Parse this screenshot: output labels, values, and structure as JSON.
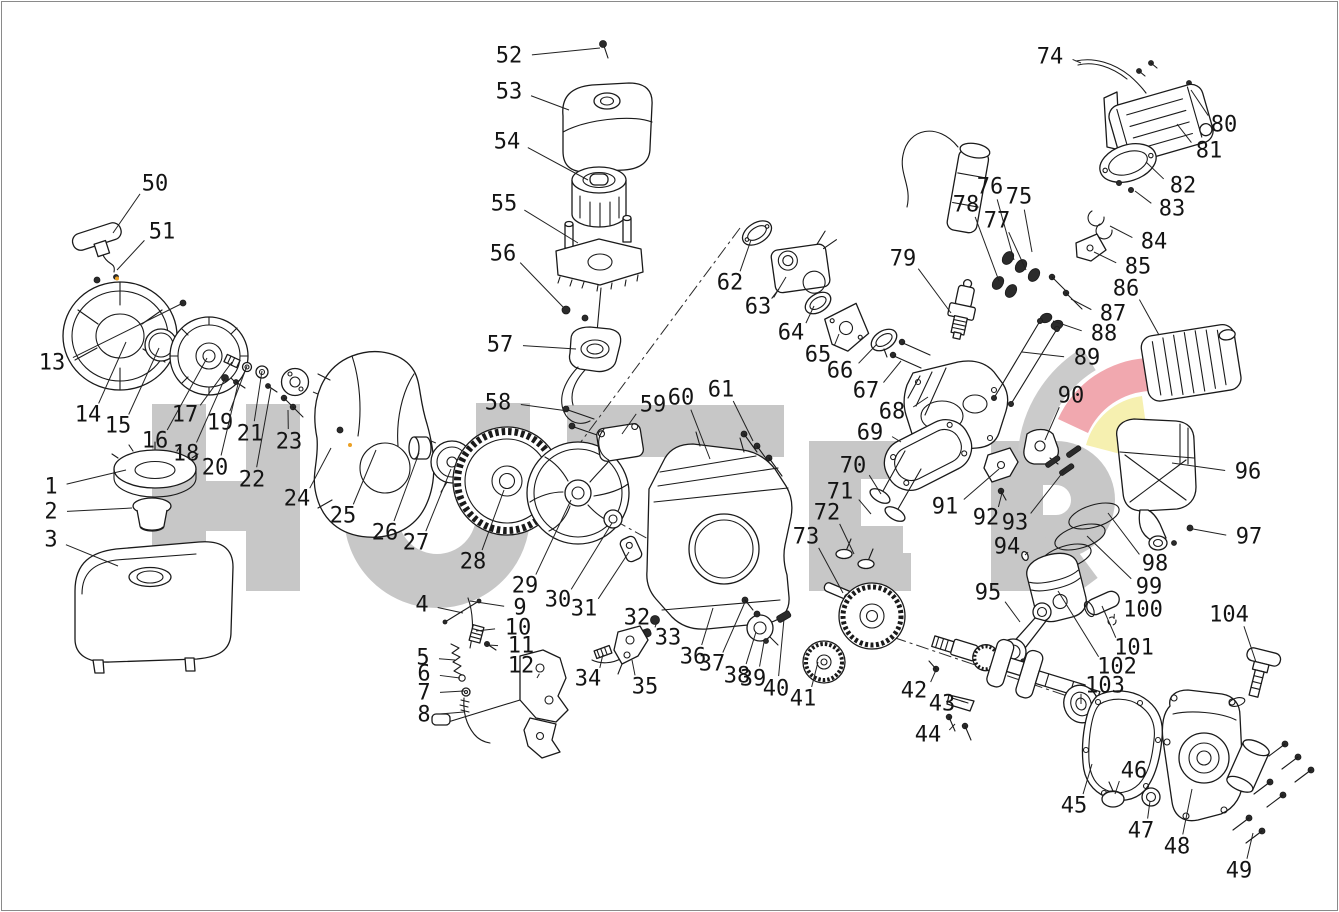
{
  "watermark": {
    "text": "HUTER",
    "letters_color": "#c7c7c7",
    "swoosh_gray": "#cbcbcb",
    "swoosh_red": "#f1a8af",
    "swoosh_yellow": "#f6f0b0"
  },
  "diagram": {
    "type": "exploded-parts-diagram",
    "part_count": 104,
    "accent_dot_color": "#eba024",
    "parts": [
      {
        "n": "1",
        "l": [
          51,
          487
        ],
        "t": [
          126,
          470
        ]
      },
      {
        "n": "2",
        "l": [
          51,
          512
        ],
        "t": [
          132,
          508
        ]
      },
      {
        "n": "3",
        "l": [
          51,
          540
        ],
        "t": [
          118,
          566
        ]
      },
      {
        "n": "4",
        "l": [
          422,
          605
        ],
        "t": [
          463,
          613
        ]
      },
      {
        "n": "5",
        "l": [
          423,
          658
        ],
        "t": [
          455,
          660
        ]
      },
      {
        "n": "6",
        "l": [
          424,
          674
        ],
        "t": [
          460,
          678
        ]
      },
      {
        "n": "7",
        "l": [
          424,
          693
        ],
        "t": [
          464,
          691
        ]
      },
      {
        "n": "8",
        "l": [
          424,
          715
        ],
        "t": [
          464,
          712
        ]
      },
      {
        "n": "9",
        "l": [
          520,
          608
        ],
        "t": [
          470,
          601
        ]
      },
      {
        "n": "10",
        "l": [
          518,
          628
        ],
        "t": [
          476,
          631
        ]
      },
      {
        "n": "11",
        "l": [
          521,
          646
        ],
        "t": [
          488,
          645
        ]
      },
      {
        "n": "12",
        "l": [
          521,
          666
        ],
        "t": [
          537,
          678
        ]
      },
      {
        "n": "13",
        "l": [
          52,
          363
        ],
        "t": [
          183,
          303
        ]
      },
      {
        "n": "14",
        "l": [
          88,
          415
        ],
        "t": [
          126,
          342
        ]
      },
      {
        "n": "15",
        "l": [
          118,
          426
        ],
        "t": [
          159,
          348
        ]
      },
      {
        "n": "16",
        "l": [
          155,
          441
        ],
        "t": [
          207,
          358
        ]
      },
      {
        "n": "17",
        "l": [
          185,
          415
        ],
        "t": [
          232,
          362
        ]
      },
      {
        "n": "18",
        "l": [
          186,
          454
        ],
        "t": [
          225,
          378
        ]
      },
      {
        "n": "19",
        "l": [
          220,
          423
        ],
        "t": [
          247,
          366
        ]
      },
      {
        "n": "20",
        "l": [
          215,
          468
        ],
        "t": [
          238,
          384
        ]
      },
      {
        "n": "21",
        "l": [
          250,
          434
        ],
        "t": [
          262,
          371
        ]
      },
      {
        "n": "22",
        "l": [
          252,
          480
        ],
        "t": [
          271,
          388
        ]
      },
      {
        "n": "23",
        "l": [
          289,
          442
        ],
        "t": [
          288,
          410
        ]
      },
      {
        "n": "24",
        "l": [
          297,
          499
        ],
        "t": [
          331,
          448
        ]
      },
      {
        "n": "25",
        "l": [
          343,
          516
        ],
        "t": [
          376,
          450
        ]
      },
      {
        "n": "26",
        "l": [
          385,
          533
        ],
        "t": [
          419,
          453
        ]
      },
      {
        "n": "27",
        "l": [
          416,
          543
        ],
        "t": [
          451,
          469
        ]
      },
      {
        "n": "28",
        "l": [
          473,
          562
        ],
        "t": [
          504,
          490
        ]
      },
      {
        "n": "29",
        "l": [
          525,
          586
        ],
        "t": [
          571,
          500
        ]
      },
      {
        "n": "30",
        "l": [
          558,
          600
        ],
        "t": [
          612,
          523
        ]
      },
      {
        "n": "31",
        "l": [
          584,
          609
        ],
        "t": [
          629,
          552
        ]
      },
      {
        "n": "32",
        "l": [
          637,
          618
        ],
        "t": [
          644,
          632
        ]
      },
      {
        "n": "33",
        "l": [
          668,
          638
        ],
        "t": [
          657,
          622
        ]
      },
      {
        "n": "34",
        "l": [
          588,
          679
        ],
        "t": [
          603,
          654
        ]
      },
      {
        "n": "35",
        "l": [
          645,
          687
        ],
        "t": [
          632,
          660
        ]
      },
      {
        "n": "36",
        "l": [
          693,
          657
        ],
        "t": [
          713,
          608
        ]
      },
      {
        "n": "37",
        "l": [
          712,
          664
        ],
        "t": [
          745,
          602
        ]
      },
      {
        "n": "38",
        "l": [
          737,
          676
        ],
        "t": [
          756,
          632
        ]
      },
      {
        "n": "39",
        "l": [
          753,
          679
        ],
        "t": [
          764,
          642
        ]
      },
      {
        "n": "40",
        "l": [
          776,
          689
        ],
        "t": [
          784,
          619
        ]
      },
      {
        "n": "41",
        "l": [
          803,
          699
        ],
        "t": [
          818,
          662
        ]
      },
      {
        "n": "42",
        "l": [
          914,
          691
        ],
        "t": [
          936,
          670
        ]
      },
      {
        "n": "43",
        "l": [
          942,
          704
        ],
        "t": [
          961,
          701
        ]
      },
      {
        "n": "44",
        "l": [
          928,
          735
        ],
        "t": [
          955,
          724
        ]
      },
      {
        "n": "45",
        "l": [
          1074,
          806
        ],
        "t": [
          1092,
          764
        ]
      },
      {
        "n": "46",
        "l": [
          1134,
          771
        ],
        "t": [
          1115,
          794
        ]
      },
      {
        "n": "47",
        "l": [
          1141,
          831
        ],
        "t": [
          1150,
          801
        ]
      },
      {
        "n": "48",
        "l": [
          1177,
          847
        ],
        "t": [
          1192,
          789
        ]
      },
      {
        "n": "49",
        "l": [
          1239,
          871
        ],
        "t": [
          1253,
          833
        ]
      },
      {
        "n": "50",
        "l": [
          155,
          184
        ],
        "t": [
          113,
          233
        ]
      },
      {
        "n": "51",
        "l": [
          162,
          232
        ],
        "t": [
          117,
          270
        ]
      },
      {
        "n": "52",
        "l": [
          509,
          56
        ],
        "t": [
          600,
          48
        ]
      },
      {
        "n": "53",
        "l": [
          509,
          92
        ],
        "t": [
          569,
          110
        ]
      },
      {
        "n": "54",
        "l": [
          507,
          142
        ],
        "t": [
          588,
          180
        ]
      },
      {
        "n": "55",
        "l": [
          504,
          204
        ],
        "t": [
          578,
          243
        ]
      },
      {
        "n": "56",
        "l": [
          503,
          254
        ],
        "t": [
          564,
          308
        ]
      },
      {
        "n": "57",
        "l": [
          500,
          345
        ],
        "t": [
          576,
          349
        ]
      },
      {
        "n": "58",
        "l": [
          498,
          403
        ],
        "t": [
          568,
          411
        ]
      },
      {
        "n": "59",
        "l": [
          653,
          405
        ],
        "t": [
          622,
          434
        ]
      },
      {
        "n": "60",
        "l": [
          681,
          398
        ],
        "t": [
          710,
          459
        ]
      },
      {
        "n": "61",
        "l": [
          721,
          390
        ],
        "t": [
          753,
          441
        ]
      },
      {
        "n": "62",
        "l": [
          730,
          283
        ],
        "t": [
          751,
          240
        ]
      },
      {
        "n": "63",
        "l": [
          758,
          307
        ],
        "t": [
          786,
          277
        ]
      },
      {
        "n": "64",
        "l": [
          791,
          333
        ],
        "t": [
          814,
          306
        ]
      },
      {
        "n": "65",
        "l": [
          818,
          355
        ],
        "t": [
          839,
          334
        ]
      },
      {
        "n": "66",
        "l": [
          840,
          371
        ],
        "t": [
          877,
          344
        ]
      },
      {
        "n": "67",
        "l": [
          866,
          391
        ],
        "t": [
          901,
          361
        ]
      },
      {
        "n": "68",
        "l": [
          892,
          412
        ],
        "t": [
          928,
          397
        ]
      },
      {
        "n": "69",
        "l": [
          870,
          433
        ],
        "t": [
          901,
          442
        ]
      },
      {
        "n": "70",
        "l": [
          853,
          466
        ],
        "t": [
          881,
          494
        ]
      },
      {
        "n": "71",
        "l": [
          840,
          492
        ],
        "t": [
          871,
          514
        ]
      },
      {
        "n": "72",
        "l": [
          827,
          513
        ],
        "t": [
          854,
          554
        ]
      },
      {
        "n": "73",
        "l": [
          806,
          537
        ],
        "t": [
          843,
          593
        ]
      },
      {
        "n": "74",
        "l": [
          1050,
          57
        ],
        "t": [
          1081,
          63
        ]
      },
      {
        "n": "75",
        "l": [
          1019,
          197
        ],
        "t": [
          1032,
          252
        ]
      },
      {
        "n": "76",
        "l": [
          990,
          187
        ],
        "t": [
          1014,
          260
        ]
      },
      {
        "n": "77",
        "l": [
          997,
          221
        ],
        "t": [
          1026,
          270
        ]
      },
      {
        "n": "78",
        "l": [
          966,
          205
        ],
        "t": [
          999,
          281
        ]
      },
      {
        "n": "79",
        "l": [
          903,
          259
        ],
        "t": [
          951,
          313
        ]
      },
      {
        "n": "80",
        "l": [
          1224,
          125
        ],
        "t": [
          1191,
          90
        ]
      },
      {
        "n": "81",
        "l": [
          1209,
          151
        ],
        "t": [
          1177,
          124
        ]
      },
      {
        "n": "82",
        "l": [
          1183,
          186
        ],
        "t": [
          1146,
          162
        ]
      },
      {
        "n": "83",
        "l": [
          1172,
          209
        ],
        "t": [
          1135,
          191
        ]
      },
      {
        "n": "84",
        "l": [
          1154,
          242
        ],
        "t": [
          1110,
          226
        ]
      },
      {
        "n": "85",
        "l": [
          1138,
          267
        ],
        "t": [
          1094,
          252
        ]
      },
      {
        "n": "86",
        "l": [
          1126,
          289
        ],
        "t": [
          1159,
          335
        ]
      },
      {
        "n": "87",
        "l": [
          1113,
          314
        ],
        "t": [
          1071,
          299
        ]
      },
      {
        "n": "88",
        "l": [
          1104,
          334
        ],
        "t": [
          1053,
          321
        ]
      },
      {
        "n": "89",
        "l": [
          1087,
          358
        ],
        "t": [
          1022,
          352
        ]
      },
      {
        "n": "90",
        "l": [
          1071,
          396
        ],
        "t": [
          1045,
          440
        ]
      },
      {
        "n": "91",
        "l": [
          945,
          507
        ],
        "t": [
          999,
          469
        ]
      },
      {
        "n": "92",
        "l": [
          986,
          518
        ],
        "t": [
          1002,
          493
        ]
      },
      {
        "n": "93",
        "l": [
          1015,
          523
        ],
        "t": [
          1067,
          467
        ]
      },
      {
        "n": "94",
        "l": [
          1007,
          547
        ],
        "t": [
          1025,
          555
        ]
      },
      {
        "n": "95",
        "l": [
          988,
          593
        ],
        "t": [
          1020,
          622
        ]
      },
      {
        "n": "96",
        "l": [
          1248,
          472
        ],
        "t": [
          1172,
          463
        ]
      },
      {
        "n": "97",
        "l": [
          1249,
          537
        ],
        "t": [
          1193,
          529
        ]
      },
      {
        "n": "98",
        "l": [
          1155,
          564
        ],
        "t": [
          1108,
          513
        ]
      },
      {
        "n": "99",
        "l": [
          1149,
          587
        ],
        "t": [
          1087,
          536
        ]
      },
      {
        "n": "100",
        "l": [
          1143,
          610
        ],
        "t": [
          1114,
          619
        ]
      },
      {
        "n": "101",
        "l": [
          1134,
          648
        ],
        "t": [
          1102,
          606
        ]
      },
      {
        "n": "102",
        "l": [
          1117,
          667
        ],
        "t": [
          1058,
          591
        ]
      },
      {
        "n": "103",
        "l": [
          1105,
          686
        ],
        "t": [
          1081,
          704
        ]
      },
      {
        "n": "104",
        "l": [
          1229,
          615
        ],
        "t": [
          1256,
          662
        ]
      }
    ]
  }
}
